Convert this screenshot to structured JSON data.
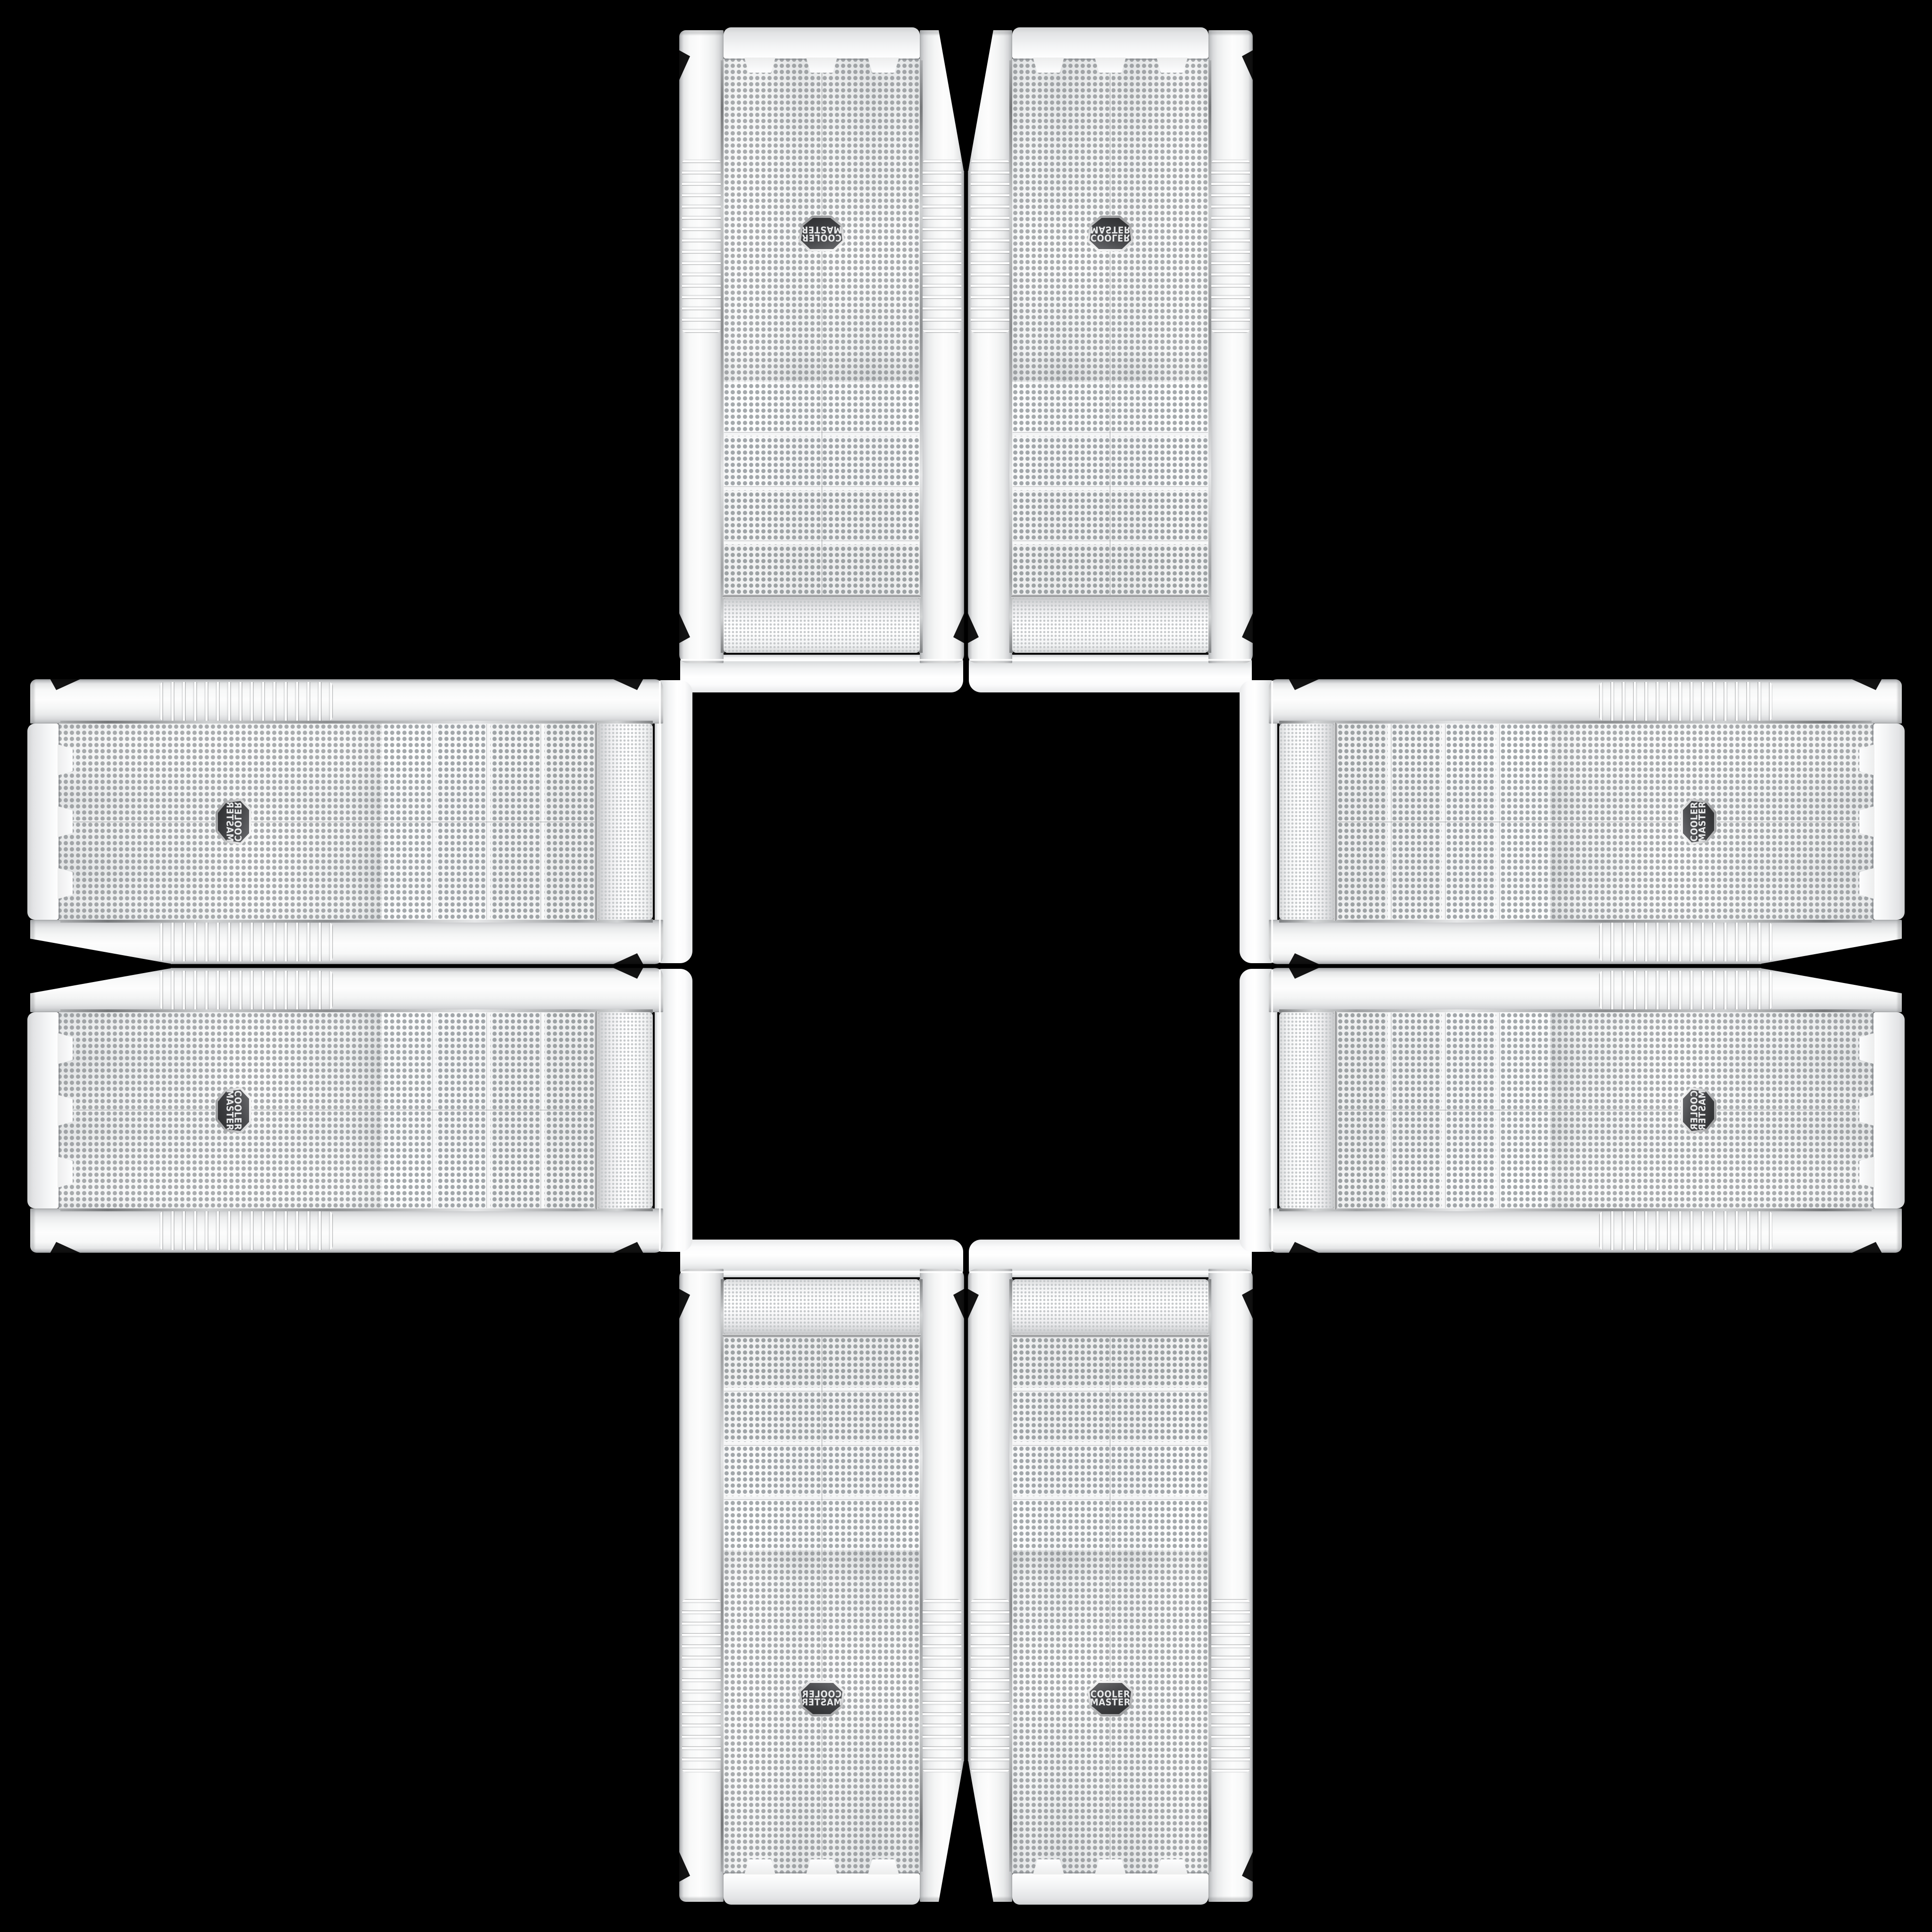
{
  "scene": {
    "background": "#000000",
    "description": "Eight identical white Cooler Master PC tower cases arranged in a plus / cross pattern on a black background; each arm of the cross is a mirrored pair and the arms are rotated copies of the same product photo",
    "case_count": 8,
    "arms": [
      "top",
      "bottom",
      "left",
      "right"
    ]
  },
  "brand": {
    "line1": "COOLER",
    "line2": "MASTER"
  },
  "case_features": {
    "front_mesh": "perforated dot mesh",
    "drive_bay_covers": 4,
    "badge": "dark hexagonal Cooler Master emblem centered on lower mesh",
    "side_rails": "white plastic rails with ribbed grip section",
    "base": "molded white base bar with three raised tabs"
  },
  "colors": {
    "bg": "#000000",
    "case-white": "#f5f6f6",
    "rail-dark": "#a6a8aa",
    "mesh-bg": "#eef0f1",
    "mesh-dot": "#a4a8ab",
    "bay-dot": "#9fa4a7",
    "dome-bg": "#fafbfb",
    "dome-dot": "#c6c9cb",
    "chrome": "#9b9da0",
    "badge-bg": "#3f4043",
    "badge-rim": "#d8d9da",
    "badge-text": "#e8e9ea"
  }
}
